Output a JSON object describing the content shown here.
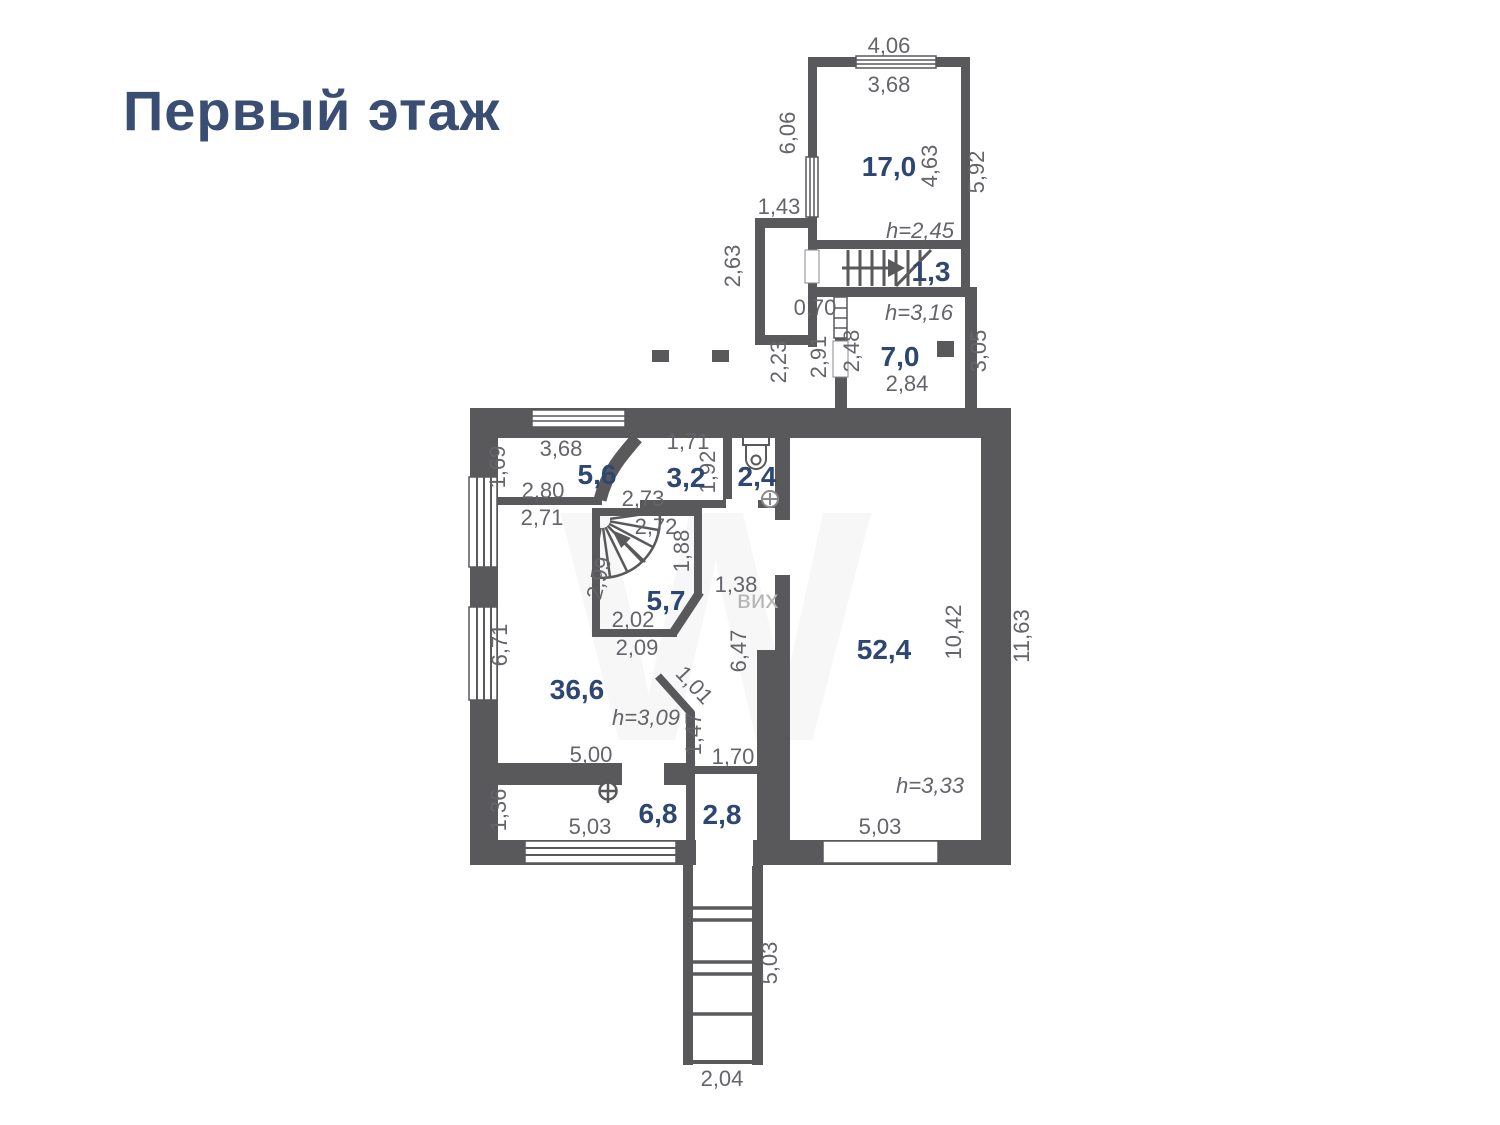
{
  "title": "Первый этаж",
  "colors": {
    "wall": "#59595b",
    "accent": "#3a4e73",
    "dim": "#64646a"
  },
  "watermark": {
    "big": "W",
    "small": "вих"
  },
  "rooms": [
    {
      "id": "room-17-0",
      "area": "17,0",
      "x": 889,
      "y": 176
    },
    {
      "id": "room-1-3",
      "area": "1,3",
      "x": 931,
      "y": 281
    },
    {
      "id": "room-7-0",
      "area": "7,0",
      "x": 900,
      "y": 366
    },
    {
      "id": "room-5-6",
      "area": "5,6",
      "x": 597,
      "y": 484
    },
    {
      "id": "room-3-2",
      "area": "3,2",
      "x": 686,
      "y": 487
    },
    {
      "id": "room-2-4",
      "area": "2,4",
      "x": 757,
      "y": 486
    },
    {
      "id": "room-5-7",
      "area": "5,7",
      "x": 666,
      "y": 610
    },
    {
      "id": "room-36-6",
      "area": "36,6",
      "x": 577,
      "y": 699
    },
    {
      "id": "room-52-4",
      "area": "52,4",
      "x": 884,
      "y": 659
    },
    {
      "id": "room-6-8",
      "area": "6,8",
      "x": 658,
      "y": 823
    },
    {
      "id": "room-2-8",
      "area": "2,8",
      "x": 722,
      "y": 824
    }
  ],
  "dims": [
    {
      "v": "4,06",
      "x": 889,
      "y": 53
    },
    {
      "v": "3,68",
      "x": 889,
      "y": 92
    },
    {
      "v": "6,06",
      "x": 795,
      "y": 133,
      "r": -90
    },
    {
      "v": "1,43",
      "x": 779,
      "y": 214
    },
    {
      "v": "4,63",
      "x": 937,
      "y": 166,
      "r": -90
    },
    {
      "v": "5,92",
      "x": 984,
      "y": 172,
      "r": -90
    },
    {
      "v": "h=2,45",
      "x": 920,
      "y": 238,
      "h": true
    },
    {
      "v": "2,63",
      "x": 740,
      "y": 266,
      "r": -90
    },
    {
      "v": "0,70",
      "x": 815,
      "y": 315
    },
    {
      "v": "h=3,16",
      "x": 919,
      "y": 320,
      "h": true
    },
    {
      "v": "2,23",
      "x": 786,
      "y": 362,
      "r": -90
    },
    {
      "v": "2,91",
      "x": 826,
      "y": 357,
      "r": -90
    },
    {
      "v": "2,48",
      "x": 859,
      "y": 351,
      "r": -90
    },
    {
      "v": "2,84",
      "x": 907,
      "y": 391
    },
    {
      "v": "3,05",
      "x": 986,
      "y": 351,
      "r": -90
    },
    {
      "v": "3,68",
      "x": 561,
      "y": 456
    },
    {
      "v": "1,69",
      "x": 505,
      "y": 467,
      "r": -90
    },
    {
      "v": "1,71",
      "x": 688,
      "y": 449
    },
    {
      "v": "1,92",
      "x": 715,
      "y": 472,
      "r": -90
    },
    {
      "v": "2,80",
      "x": 543,
      "y": 498
    },
    {
      "v": "2,73",
      "x": 643,
      "y": 506
    },
    {
      "v": "2,71",
      "x": 542,
      "y": 525
    },
    {
      "v": "2,72",
      "x": 656,
      "y": 534
    },
    {
      "v": "1,88",
      "x": 689,
      "y": 551,
      "r": -90
    },
    {
      "v": "2,99",
      "x": 606,
      "y": 580,
      "r": -75
    },
    {
      "v": "1,38",
      "x": 736,
      "y": 592
    },
    {
      "v": "2,02",
      "x": 633,
      "y": 627
    },
    {
      "v": "2,09",
      "x": 637,
      "y": 655
    },
    {
      "v": "6,71",
      "x": 507,
      "y": 645,
      "r": -90
    },
    {
      "v": "6,47",
      "x": 746,
      "y": 651,
      "r": -90
    },
    {
      "v": "10,42",
      "x": 961,
      "y": 632,
      "r": -90
    },
    {
      "v": "11,63",
      "x": 1029,
      "y": 636,
      "r": -90
    },
    {
      "v": "1,01",
      "x": 689,
      "y": 690,
      "r": 47
    },
    {
      "v": "h=3,09",
      "x": 646,
      "y": 725,
      "h": true
    },
    {
      "v": "1,47",
      "x": 701,
      "y": 734,
      "r": -90
    },
    {
      "v": "5,00",
      "x": 591,
      "y": 762
    },
    {
      "v": "1,70",
      "x": 733,
      "y": 764
    },
    {
      "v": "1,36",
      "x": 506,
      "y": 810,
      "r": -90
    },
    {
      "v": "5,03",
      "x": 590,
      "y": 834
    },
    {
      "v": "h=3,33",
      "x": 930,
      "y": 793,
      "h": true
    },
    {
      "v": "5,03",
      "x": 880,
      "y": 834
    },
    {
      "v": "5,03",
      "x": 777,
      "y": 963,
      "r": -90
    },
    {
      "v": "2,04",
      "x": 722,
      "y": 1086
    }
  ]
}
